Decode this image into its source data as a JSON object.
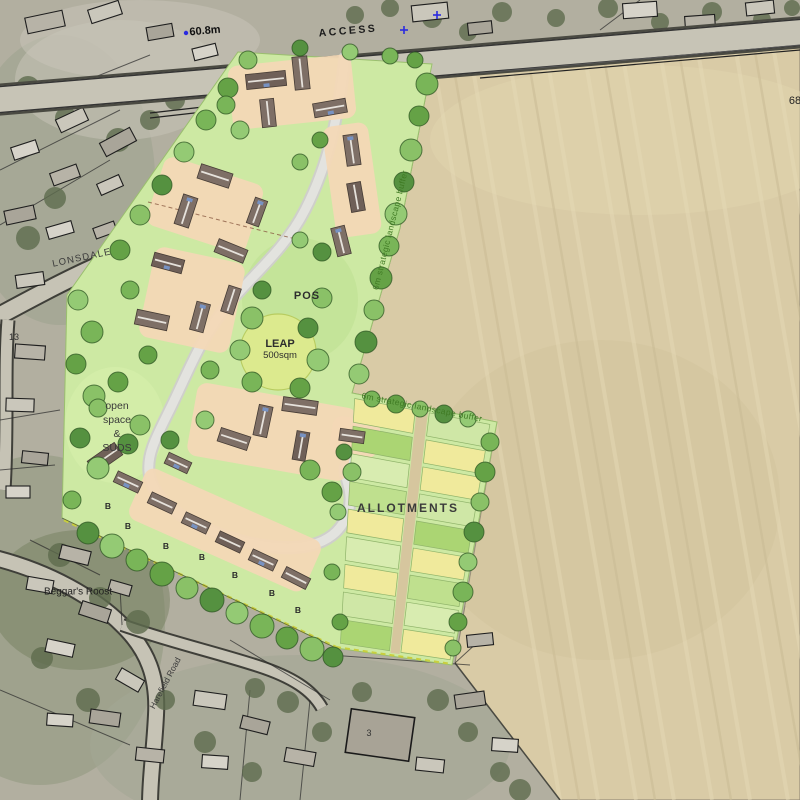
{
  "map": {
    "road_labels": {
      "access": "ACCESS",
      "lonsdale": "LONSDALE",
      "harefield_road": "Harefield Road"
    },
    "annotations": {
      "spot_height": "60.8m",
      "spot_height_partial": "68",
      "pos": "POS",
      "leap_line1": "LEAP",
      "leap_line2": "500sqm",
      "open_space_line1": "open",
      "open_space_line2": "space",
      "open_space_line3": "&",
      "open_space_line4": "SUDS",
      "landscape_buffer": "6m strategic landscape buffer",
      "allotments": "ALLOTMENTS",
      "beggars_roost": "Beggar's Roost",
      "bungalow_marker": "B",
      "house_number_3": "3",
      "house_number_13": "13"
    },
    "colors": {
      "site_green": "#cde9a3",
      "field_tan": "#d9cba6",
      "allotment_yellow": "#f0ea9c",
      "allotment_green": "#abd573",
      "buffer_text_green": "#3f7a23",
      "marker_blue": "#2a2ae0",
      "leap_yellow_green": "#dcea8e",
      "masterplan_house_brown": "#7e6f66",
      "plot_peach": "#f3d8b6"
    }
  }
}
